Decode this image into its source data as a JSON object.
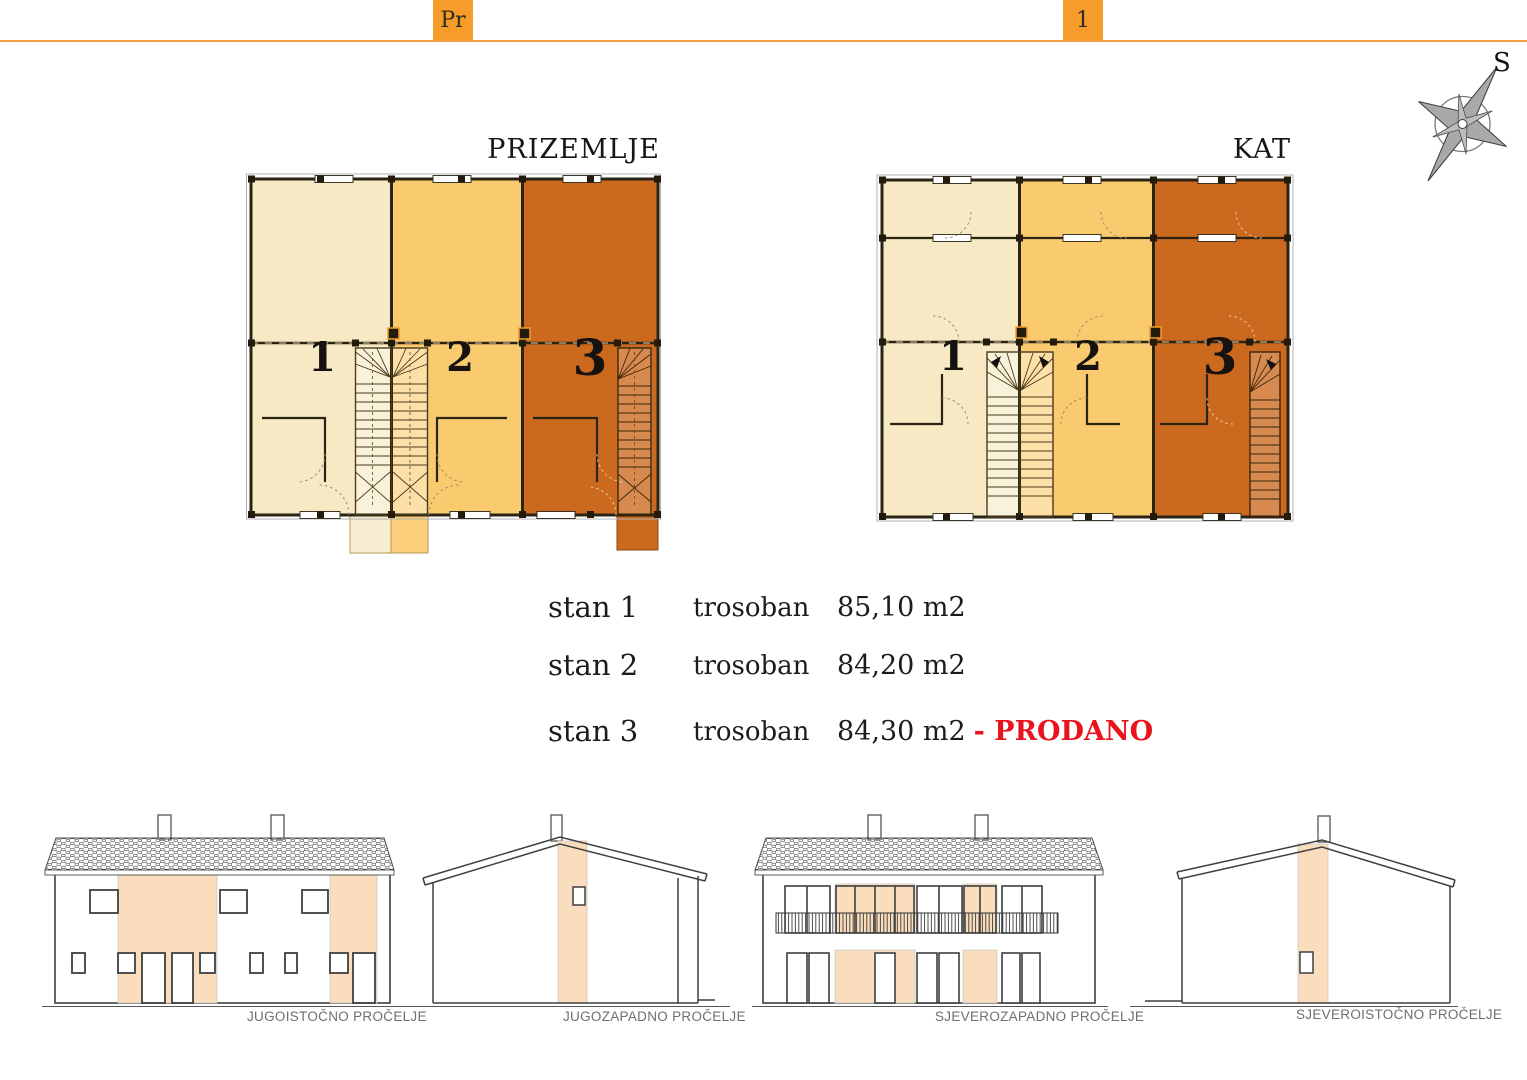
{
  "header": {
    "floor_tabs": [
      {
        "label": "Pr"
      },
      {
        "label": "1"
      }
    ]
  },
  "compass": {
    "label": "S"
  },
  "plans": {
    "ground": {
      "title": "PRIZEMLJE",
      "units": [
        "1",
        "2",
        "3"
      ]
    },
    "upper": {
      "title": "KAT",
      "units": [
        "1",
        "2",
        "3"
      ]
    }
  },
  "apartments": {
    "rows": [
      {
        "name": "stan 1",
        "type": "trosoban",
        "area": "85,10 m2",
        "status": ""
      },
      {
        "name": "stan 2",
        "type": "trosoban",
        "area": "84,20 m2",
        "status": ""
      },
      {
        "name": "stan 3",
        "type": "trosoban",
        "area": "84,30 m2",
        "status": "- PRODANO"
      }
    ]
  },
  "elevations": [
    {
      "caption": "JUGOISTOČNO PROČELJE"
    },
    {
      "caption": "JUGOZAPADNO PROČELJE"
    },
    {
      "caption": "SJEVEROZAPADNO PROČELJE"
    },
    {
      "caption": "SJEVEROISTOČNO PROČELJE"
    }
  ],
  "colors": {
    "accent": "#F59C2B",
    "rule": "#F0A143",
    "unit1_cream": "#F6E9C3",
    "unit2_amber": "#FACB6E",
    "unit3_terracotta": "#CB6A1F",
    "sold_red": "#E8131D",
    "facade_panel": "#FADDBD"
  }
}
